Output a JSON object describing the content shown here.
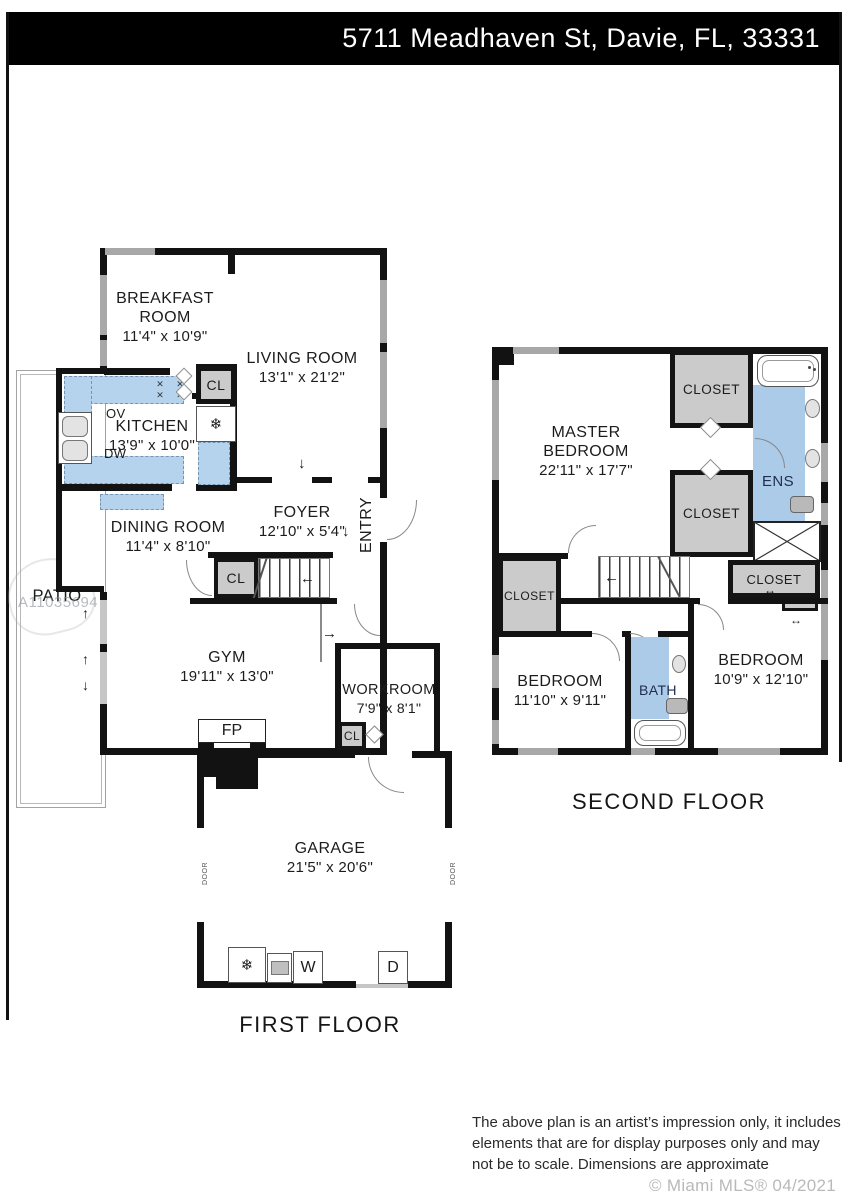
{
  "header": {
    "address": "5711 Meadhaven St, Davie, FL, 33331",
    "bg": "#000000",
    "text_color": "#ffffff"
  },
  "watermark": {
    "id": "A11035694"
  },
  "floors": {
    "first": {
      "title": "FIRST FLOOR",
      "rooms": {
        "breakfast": {
          "name": "BREAKFAST ROOM",
          "dims": "11'4\" x 10'9\""
        },
        "living": {
          "name": "LIVING ROOM",
          "dims": "13'1\" x 21'2\""
        },
        "kitchen": {
          "name": "KITCHEN",
          "dims": "13'9\" x 10'0\""
        },
        "dining": {
          "name": "DINING ROOM",
          "dims": "11'4\" x 8'10\""
        },
        "foyer": {
          "name": "FOYER",
          "dims": "12'10\" x 5'4\""
        },
        "gym": {
          "name": "GYM",
          "dims": "19'11\" x 13'0\""
        },
        "workroom": {
          "name": "WORKROOM",
          "dims": "7'9\" x 8'1\""
        },
        "garage": {
          "name": "GARAGE",
          "dims": "21'5\" x 20'6\""
        },
        "patio": {
          "name": "PATIO"
        },
        "entry": {
          "name": "ENTRY"
        }
      },
      "labels": {
        "cl": "CL",
        "fireplace": "FP",
        "oven": "OV",
        "dishwasher": "DW",
        "washer": "W",
        "dryer": "D",
        "door": "DOOR"
      }
    },
    "second": {
      "title": "SECOND FLOOR",
      "rooms": {
        "master": {
          "name": "MASTER BEDROOM",
          "dims": "22'11\" x 17'7\""
        },
        "bedroom_left": {
          "name": "BEDROOM",
          "dims": "11'10\" x 9'11\""
        },
        "bedroom_right": {
          "name": "BEDROOM",
          "dims": "10'9\" x 12'10\""
        },
        "bath": {
          "name": "BATH"
        },
        "ensuite": {
          "name": "ENS"
        }
      },
      "labels": {
        "closet": "CLOSET"
      }
    }
  },
  "footer": {
    "disclaimer_lines": [
      "The above plan is an artist’s impression only, it includes",
      "elements that are for display purposes only and may",
      "not be to scale. Dimensions are approximate"
    ],
    "copyright": "© Miami MLS® 04/2021"
  },
  "icons": {
    "snowflake": "❄",
    "burner": "✕",
    "arrow_down": "↓",
    "arrow_up": "↑",
    "arrow_left": "←",
    "arrow_right": "→",
    "arrow_both": "↔"
  },
  "colors": {
    "wall": "#121212",
    "window_gray": "#a8a8a8",
    "counter_blue": "#b5d3ec",
    "bath_blue": "#abcbe9",
    "closet_gray": "#cbcbcb",
    "header_bg": "#000000"
  }
}
